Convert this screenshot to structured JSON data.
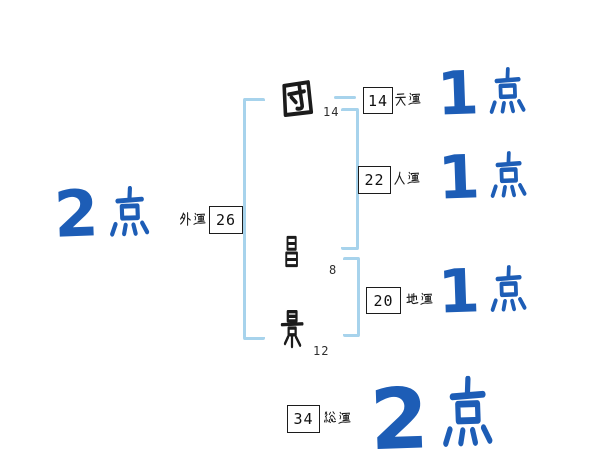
{
  "name": {
    "characters": [
      {
        "char": "団",
        "stroke_count": "14"
      },
      {
        "char": "昌",
        "stroke_count": "8"
      },
      {
        "char": "景",
        "stroke_count": "12"
      }
    ]
  },
  "fortunes": {
    "ten": {
      "label": "天運",
      "value": "14",
      "score_digit": "1",
      "score_unit": "点"
    },
    "jin": {
      "label": "人運",
      "value": "22",
      "score_digit": "1",
      "score_unit": "点"
    },
    "chi": {
      "label": "地運",
      "value": "20",
      "score_digit": "1",
      "score_unit": "点"
    },
    "gai": {
      "label": "外運",
      "value": "26",
      "score_digit": "2",
      "score_unit": "点"
    },
    "sou": {
      "label": "総運",
      "value": "34",
      "score_digit": "2",
      "score_unit": "点"
    }
  },
  "palette": {
    "ink": "#1c1c1c",
    "score_blue": "#1d5db6",
    "bracket_blue": "#a7d3ec",
    "background": "#ffffff"
  }
}
